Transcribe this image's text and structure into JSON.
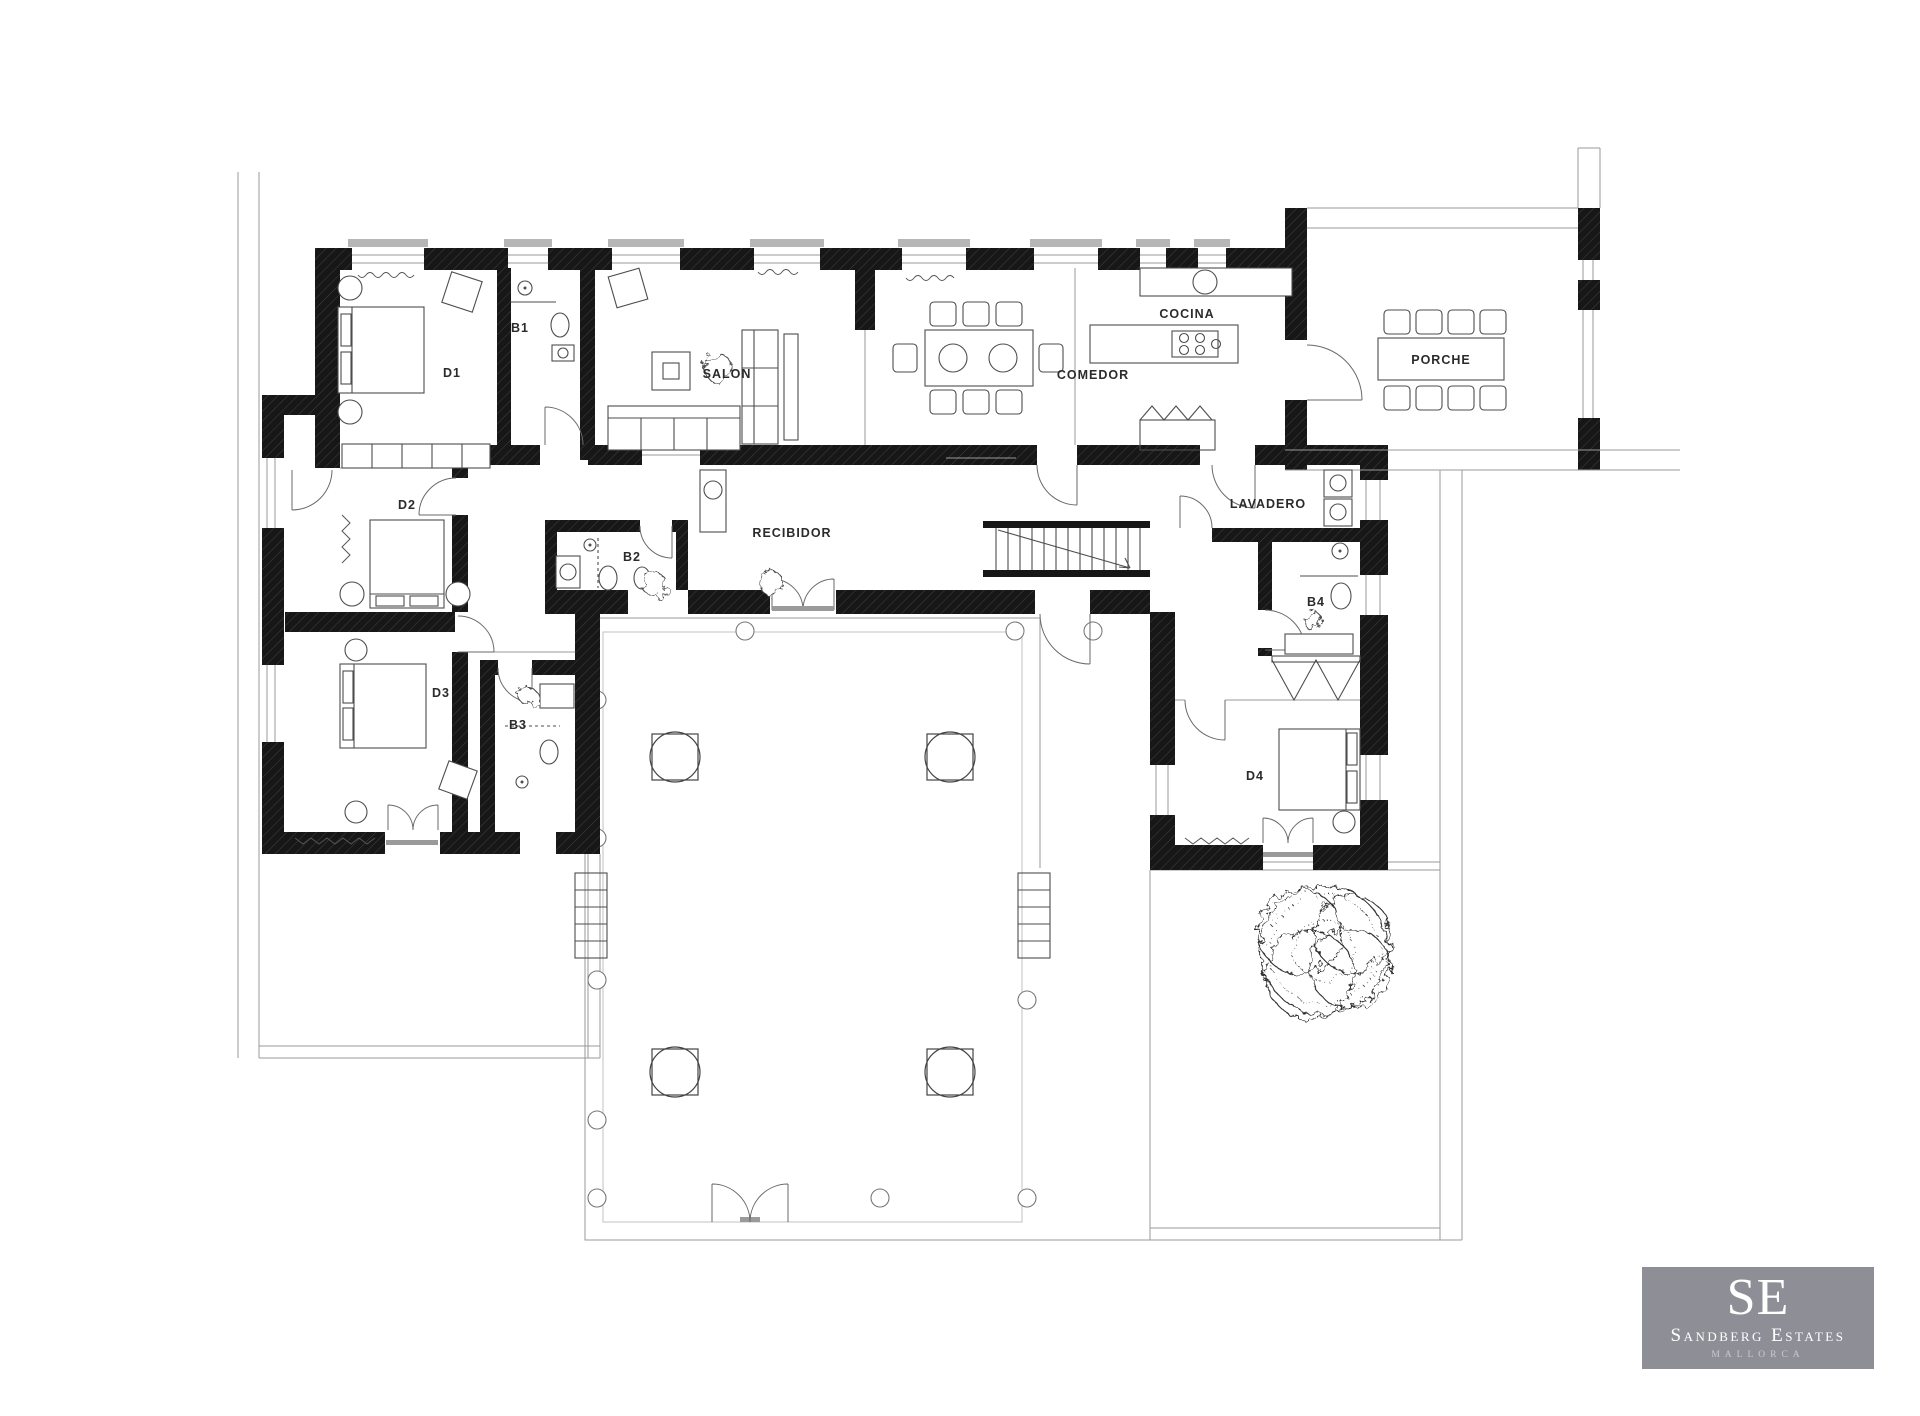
{
  "plan": {
    "labels": {
      "d1": "D1",
      "b1": "B1",
      "d2": "D2",
      "b2": "B2",
      "d3": "D3",
      "b3": "B3",
      "d4": "D4",
      "b4": "B4",
      "salon": "SALON",
      "comedor": "COMEDOR",
      "cocina": "COCINA",
      "recibidor": "RECIBIDOR",
      "lavadero": "LAVADERO",
      "porche": "PORCHE"
    }
  },
  "logo": {
    "initials": "SE",
    "name": "Sandberg Estates",
    "location": "MALLORCA",
    "background_color": "#8e8e96",
    "text_color": "#ffffff"
  }
}
